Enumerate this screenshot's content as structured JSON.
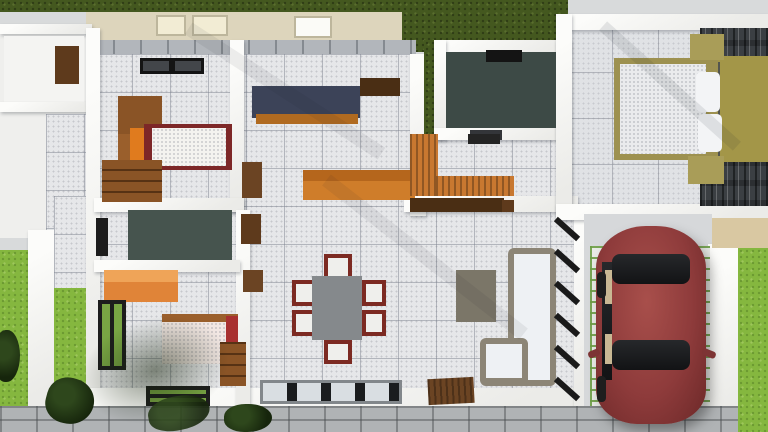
{
  "meta": {
    "canvas_width": 768,
    "canvas_height": 432,
    "content": "3d-house-floor-plan-top-view-render"
  },
  "palette": {
    "lawn_dark": "#44581f",
    "lawn_bright": "#85b73f",
    "wall_white": "#f5f5f2",
    "tile_floor": "#e6e7e9",
    "bath_floor_teal": "#3d4a46",
    "kitchen_counter_navy": "#3c4358",
    "wood_orange": "#cf7d2a",
    "wardrobe_orange": "#e08438",
    "wood_brown": "#8a5426",
    "bed_frame_red": "#7d2727",
    "blanket_red": "#a83030",
    "khaki_bed": "#a99d58",
    "stone_accent": "#3b3f43",
    "sofa_frame": "#8c8576",
    "cushion_white": "#eef1f4",
    "table_grey": "#85898c",
    "chair_red": "#7c2a22",
    "car_maroon": "#8e3b3b",
    "paver_joint_green": "#6d9e46",
    "concrete": "#d8dadb",
    "fence_grey": "#b0b3b5",
    "door_wood": "#6b4423",
    "ceiling_beige": "#ddd5bc"
  },
  "scene": {
    "items": [
      {
        "n": "ground-concrete",
        "x": 0,
        "y": 0,
        "w": 768,
        "h": 432,
        "bg": "#d8dadb"
      },
      {
        "n": "ceiling-band",
        "x": 86,
        "y": 10,
        "w": 326,
        "h": 32,
        "bg": "#ddd5bc"
      },
      {
        "n": "lawn-back",
        "x": 0,
        "y": 0,
        "w": 566,
        "h": 12,
        "cls": "grass-d"
      },
      {
        "n": "lawn-notch",
        "x": 402,
        "y": 0,
        "w": 166,
        "h": 52,
        "cls": "grass-d"
      },
      {
        "n": "skylight-panel-1",
        "x": 156,
        "y": 15,
        "w": 30,
        "h": 21,
        "bg": "#f2ecd4",
        "cls": "panel"
      },
      {
        "n": "skylight-panel-2",
        "x": 192,
        "y": 15,
        "w": 36,
        "h": 21,
        "bg": "#f2ecd4",
        "cls": "panel"
      },
      {
        "n": "ceiling-light-panel",
        "x": 294,
        "y": 16,
        "w": 38,
        "h": 22,
        "bg": "#fbfbf7",
        "cls": "panel"
      },
      {
        "n": "back-wall-tiles",
        "x": 86,
        "y": 40,
        "w": 330,
        "h": 18,
        "cls": "tileband"
      },
      {
        "n": "utility-block",
        "x": 0,
        "y": 24,
        "w": 92,
        "h": 214,
        "bg": "#efefed"
      },
      {
        "n": "utility-wall-top",
        "x": 0,
        "y": 24,
        "w": 92,
        "h": 10,
        "cls": "wall"
      },
      {
        "n": "utility-room-floor",
        "x": 4,
        "y": 36,
        "w": 80,
        "h": 66,
        "bg": "#f4f4f2"
      },
      {
        "n": "utility-wall-mid",
        "x": 0,
        "y": 102,
        "w": 92,
        "h": 10,
        "cls": "wall"
      },
      {
        "n": "utility-room2-tiles",
        "x": 46,
        "y": 114,
        "w": 40,
        "h": 120,
        "cls": "tiles"
      },
      {
        "n": "utility-wood-cabinet",
        "x": 55,
        "y": 46,
        "w": 24,
        "h": 38,
        "bg": "#5e3a1c"
      },
      {
        "n": "lawn-left-outer",
        "x": 0,
        "y": 250,
        "w": 30,
        "h": 162,
        "cls": "grass-b"
      },
      {
        "n": "boundary-wall-left",
        "x": 28,
        "y": 230,
        "w": 28,
        "h": 182,
        "cls": "wall"
      },
      {
        "n": "patio-tiles-left",
        "x": 54,
        "y": 196,
        "w": 40,
        "h": 92,
        "cls": "tiles"
      },
      {
        "n": "lawn-left-inner",
        "x": 54,
        "y": 288,
        "w": 40,
        "h": 122,
        "cls": "grass-b"
      },
      {
        "n": "main-floor",
        "x": 94,
        "y": 54,
        "w": 492,
        "h": 348,
        "cls": "tiles"
      },
      {
        "n": "master-floor",
        "x": 566,
        "y": 26,
        "w": 202,
        "h": 190,
        "cls": "tiles-big"
      },
      {
        "n": "wall-main-left",
        "x": 86,
        "y": 28,
        "w": 14,
        "h": 382,
        "cls": "wall"
      },
      {
        "n": "wall-main-bottom",
        "x": 86,
        "y": 388,
        "w": 504,
        "h": 22,
        "cls": "wall"
      },
      {
        "n": "wall-living-right",
        "x": 574,
        "y": 210,
        "w": 18,
        "h": 200,
        "cls": "wall"
      },
      {
        "n": "wall-bed2-right",
        "x": 230,
        "y": 40,
        "w": 14,
        "h": 172,
        "cls": "wall"
      },
      {
        "n": "wall-bed2-bottom",
        "x": 94,
        "y": 198,
        "w": 150,
        "h": 14,
        "cls": "wall"
      },
      {
        "n": "wall-leftrooms-right",
        "x": 236,
        "y": 210,
        "w": 14,
        "h": 200,
        "cls": "wall"
      },
      {
        "n": "wall-bath2-bottom",
        "x": 94,
        "y": 260,
        "w": 146,
        "h": 12,
        "cls": "wall"
      },
      {
        "n": "wall-kitchen-right",
        "x": 410,
        "y": 54,
        "w": 16,
        "h": 162,
        "cls": "wall"
      },
      {
        "n": "lawn-bath1-left",
        "x": 424,
        "y": 40,
        "w": 14,
        "h": 94,
        "cls": "grass-d"
      },
      {
        "n": "wall-utility2-bottom",
        "x": 404,
        "y": 196,
        "w": 174,
        "h": 16,
        "cls": "wall"
      },
      {
        "n": "wall-bath1-top",
        "x": 434,
        "y": 40,
        "w": 136,
        "h": 12,
        "cls": "wall"
      },
      {
        "n": "wall-bath1-left",
        "x": 434,
        "y": 40,
        "w": 12,
        "h": 100,
        "cls": "wall"
      },
      {
        "n": "wall-bath1-bottom",
        "x": 434,
        "y": 128,
        "w": 136,
        "h": 12,
        "cls": "wall"
      },
      {
        "n": "wall-bath1-right",
        "x": 556,
        "y": 40,
        "w": 14,
        "h": 176,
        "cls": "wall"
      },
      {
        "n": "wall-master-top",
        "x": 556,
        "y": 14,
        "w": 212,
        "h": 16,
        "cls": "wall"
      },
      {
        "n": "wall-master-left",
        "x": 556,
        "y": 14,
        "w": 16,
        "h": 204,
        "cls": "wall"
      },
      {
        "n": "wall-master-bottom",
        "x": 556,
        "y": 204,
        "w": 212,
        "h": 16,
        "cls": "wall"
      },
      {
        "n": "master-stone-accent-wall",
        "x": 700,
        "y": 28,
        "w": 68,
        "h": 178,
        "cls": "stone"
      },
      {
        "n": "master-headboard-rug",
        "x": 712,
        "y": 56,
        "w": 56,
        "h": 106,
        "bg": "#a39648"
      },
      {
        "n": "master-headboard",
        "x": 708,
        "y": 62,
        "w": 12,
        "h": 96,
        "bg": "#53554f"
      },
      {
        "n": "master-bed-frame",
        "x": 614,
        "y": 58,
        "w": 104,
        "h": 102,
        "bg": "#9d9150"
      },
      {
        "n": "master-mattress",
        "x": 620,
        "y": 64,
        "w": 86,
        "h": 90,
        "bg": "#eaebed",
        "cls": "speck"
      },
      {
        "n": "master-pillow-1",
        "x": 696,
        "y": 72,
        "w": 24,
        "h": 40,
        "bg": "#f3f4f6",
        "r": 5
      },
      {
        "n": "master-pillow-2",
        "x": 698,
        "y": 114,
        "w": 24,
        "h": 38,
        "bg": "#f3f4f6",
        "r": 5
      },
      {
        "n": "master-nightstand-top",
        "x": 690,
        "y": 34,
        "w": 34,
        "h": 26,
        "bg": "#a99d58"
      },
      {
        "n": "master-nightstand-bottom",
        "x": 688,
        "y": 156,
        "w": 36,
        "h": 28,
        "bg": "#a99d58"
      },
      {
        "n": "master-floor-shadow",
        "x": 580,
        "y": 80,
        "w": 180,
        "h": 12,
        "rot": 42,
        "op": 0.1,
        "cls": "shadowstreak"
      },
      {
        "n": "bed2-ceiling-light",
        "x": 140,
        "y": 58,
        "w": 64,
        "h": 16,
        "cls": "skylight"
      },
      {
        "n": "bed2-wardrobe-upper",
        "x": 118,
        "y": 96,
        "w": 44,
        "h": 42,
        "bg": "#8a5426"
      },
      {
        "n": "bed2-wardrobe-lower",
        "x": 118,
        "y": 134,
        "w": 40,
        "h": 40,
        "bg": "#9a5f2c"
      },
      {
        "n": "bed2-wardrobe-door-orange",
        "x": 130,
        "y": 128,
        "w": 22,
        "h": 36,
        "bg": "#e07b1e"
      },
      {
        "n": "bed2-bed-frame",
        "x": 144,
        "y": 124,
        "w": 88,
        "h": 46,
        "bg": "#7d2727"
      },
      {
        "n": "bed2-mattress",
        "x": 152,
        "y": 128,
        "w": 74,
        "h": 38,
        "bg": "#f4f3ef",
        "cls": "speck"
      },
      {
        "n": "bed2-dresser",
        "x": 102,
        "y": 160,
        "w": 60,
        "h": 42,
        "bg": "#8a5426",
        "cls": "drawers"
      },
      {
        "n": "bath2-floor",
        "x": 128,
        "y": 210,
        "w": 104,
        "h": 50,
        "bg": "#46544e"
      },
      {
        "n": "bath2-window",
        "x": 96,
        "y": 218,
        "w": 12,
        "h": 38,
        "bg": "#1c1c1c"
      },
      {
        "n": "bed3-wardrobe",
        "x": 104,
        "y": 270,
        "w": 74,
        "h": 32,
        "bg": "#e08438"
      },
      {
        "n": "bed3-wardrobe-top",
        "x": 104,
        "y": 270,
        "w": 74,
        "h": 12,
        "bg": "#efa458"
      },
      {
        "n": "bed3-bed-headrail",
        "x": 162,
        "y": 314,
        "w": 76,
        "h": 10,
        "bg": "#9a5f2c"
      },
      {
        "n": "bed3-mattress",
        "x": 162,
        "y": 322,
        "w": 70,
        "h": 42,
        "bg": "#f2e7e3",
        "cls": "speck"
      },
      {
        "n": "bed3-blanket-red",
        "x": 226,
        "y": 316,
        "w": 12,
        "h": 48,
        "bg": "#a83030"
      },
      {
        "n": "bed3-nightstand",
        "x": 220,
        "y": 342,
        "w": 26,
        "h": 44,
        "bg": "#8a5426",
        "cls": "drawers"
      },
      {
        "n": "bed3-window-left",
        "x": 98,
        "y": 300,
        "w": 28,
        "h": 70,
        "cls": "window-green"
      },
      {
        "n": "bed3-window-bottom",
        "x": 146,
        "y": 386,
        "w": 64,
        "h": 20,
        "cls": "window-green-h"
      },
      {
        "n": "wall-niche-1",
        "x": 242,
        "y": 162,
        "w": 20,
        "h": 36,
        "bg": "#6b4423"
      },
      {
        "n": "wall-niche-2",
        "x": 241,
        "y": 214,
        "w": 20,
        "h": 30,
        "bg": "#5e3a1c"
      },
      {
        "n": "wall-niche-3",
        "x": 243,
        "y": 270,
        "w": 20,
        "h": 22,
        "bg": "#6b4423"
      },
      {
        "n": "dining-chair-top",
        "x": 324,
        "y": 254,
        "w": 28,
        "h": 26,
        "cls": "chair"
      },
      {
        "n": "dining-chair-bottom",
        "x": 324,
        "y": 340,
        "w": 28,
        "h": 24,
        "cls": "chair"
      },
      {
        "n": "dining-chair-left-1",
        "x": 292,
        "y": 280,
        "w": 24,
        "h": 26,
        "cls": "chair"
      },
      {
        "n": "dining-chair-left-2",
        "x": 292,
        "y": 310,
        "w": 24,
        "h": 26,
        "cls": "chair"
      },
      {
        "n": "dining-chair-right-1",
        "x": 362,
        "y": 280,
        "w": 24,
        "h": 26,
        "cls": "chair"
      },
      {
        "n": "dining-chair-right-2",
        "x": 362,
        "y": 310,
        "w": 24,
        "h": 26,
        "cls": "chair"
      },
      {
        "n": "dining-table",
        "x": 312,
        "y": 276,
        "w": 50,
        "h": 64,
        "bg": "#85898c"
      },
      {
        "n": "dining-window",
        "x": 260,
        "y": 380,
        "w": 142,
        "h": 24,
        "cls": "window-big"
      },
      {
        "n": "kitchen-counter-top",
        "x": 252,
        "y": 86,
        "w": 108,
        "h": 32,
        "bg": "#3c4358"
      },
      {
        "n": "kitchen-counter-face",
        "x": 256,
        "y": 114,
        "w": 102,
        "h": 10,
        "bg": "#b06a20"
      },
      {
        "n": "kitchen-wall-cabinet",
        "x": 360,
        "y": 78,
        "w": 40,
        "h": 18,
        "bg": "#4a2e14"
      },
      {
        "n": "kitchen-island",
        "x": 303,
        "y": 170,
        "w": 112,
        "h": 30,
        "bg": "#cf7d2a"
      },
      {
        "n": "kitchen-island-top",
        "x": 303,
        "y": 170,
        "w": 112,
        "h": 11,
        "bg": "#b5661c"
      },
      {
        "n": "bath1-floor",
        "x": 446,
        "y": 52,
        "w": 110,
        "h": 76,
        "bg": "#3d4a46"
      },
      {
        "n": "bath1-skylight",
        "x": 486,
        "y": 50,
        "w": 36,
        "h": 12,
        "bg": "#141414"
      },
      {
        "n": "bath1-door",
        "x": 470,
        "y": 130,
        "w": 32,
        "h": 10,
        "bg": "#333539"
      },
      {
        "n": "utility2-counter-left",
        "x": 410,
        "y": 134,
        "w": 28,
        "h": 62,
        "bg": "#c87830",
        "cls": "woodgrain"
      },
      {
        "n": "utility2-counter-bottom",
        "x": 436,
        "y": 176,
        "w": 78,
        "h": 20,
        "bg": "#c87830",
        "cls": "woodgrain"
      },
      {
        "n": "utility2-shelf",
        "x": 468,
        "y": 134,
        "w": 32,
        "h": 10,
        "bg": "#242424"
      },
      {
        "n": "tv-console",
        "x": 410,
        "y": 198,
        "w": 94,
        "h": 14,
        "bg": "#4a2e14"
      },
      {
        "n": "tv-console-step",
        "x": 502,
        "y": 200,
        "w": 12,
        "h": 12,
        "bg": "#5e3a1c"
      },
      {
        "n": "coffee-table",
        "x": 456,
        "y": 270,
        "w": 40,
        "h": 52,
        "bg": "#7b7668"
      },
      {
        "n": "sofa-frame-long",
        "x": 508,
        "y": 248,
        "w": 48,
        "h": 138,
        "bg": "#8c8576",
        "r": 6
      },
      {
        "n": "sofa-cushions-long",
        "x": 514,
        "y": 254,
        "w": 36,
        "h": 126,
        "bg": "#eef1f4"
      },
      {
        "n": "sofa-frame-short",
        "x": 480,
        "y": 338,
        "w": 48,
        "h": 48,
        "bg": "#8c8576",
        "r": 6
      },
      {
        "n": "sofa-cushions-short",
        "x": 486,
        "y": 344,
        "w": 36,
        "h": 34,
        "bg": "#eef1f4"
      },
      {
        "n": "window-louver-1",
        "x": 552,
        "y": 226,
        "w": 30,
        "h": 6,
        "rot": 42,
        "bg": "#1a1a1a"
      },
      {
        "n": "window-louver-2",
        "x": 552,
        "y": 258,
        "w": 30,
        "h": 6,
        "rot": 42,
        "bg": "#1a1a1a"
      },
      {
        "n": "window-louver-3",
        "x": 552,
        "y": 290,
        "w": 30,
        "h": 6,
        "rot": 42,
        "bg": "#1a1a1a"
      },
      {
        "n": "window-louver-4",
        "x": 552,
        "y": 322,
        "w": 30,
        "h": 6,
        "rot": 42,
        "bg": "#1a1a1a"
      },
      {
        "n": "window-louver-5",
        "x": 552,
        "y": 354,
        "w": 30,
        "h": 6,
        "rot": 42,
        "bg": "#1a1a1a"
      },
      {
        "n": "window-louver-6",
        "x": 552,
        "y": 386,
        "w": 30,
        "h": 6,
        "rot": 42,
        "bg": "#1a1a1a"
      },
      {
        "n": "entry-door-mat",
        "x": 428,
        "y": 378,
        "w": 46,
        "h": 26,
        "bg": "#6b4423",
        "cls": "woodgrain",
        "rot": -3
      },
      {
        "n": "garage-slab",
        "x": 584,
        "y": 214,
        "w": 128,
        "h": 218,
        "bg": "#d6d8da"
      },
      {
        "n": "garage-wall-right",
        "x": 708,
        "y": 244,
        "w": 34,
        "h": 188,
        "cls": "wall"
      },
      {
        "n": "garage-wall-top-beige",
        "x": 712,
        "y": 218,
        "w": 56,
        "h": 30,
        "bg": "#d9c8a2"
      },
      {
        "n": "driveway-pavers-left",
        "x": 590,
        "y": 246,
        "w": 32,
        "h": 164,
        "cls": "pavers"
      },
      {
        "n": "driveway-pavers-right",
        "x": 680,
        "y": 246,
        "w": 30,
        "h": 164,
        "cls": "pavers"
      },
      {
        "n": "fence-front",
        "x": 0,
        "y": 406,
        "w": 768,
        "h": 26,
        "cls": "fence"
      },
      {
        "n": "lawn-right",
        "x": 738,
        "y": 248,
        "w": 30,
        "h": 184,
        "cls": "grass-b"
      },
      {
        "n": "car-body",
        "x": 596,
        "y": 226,
        "w": 110,
        "h": 198,
        "cls": "car"
      },
      {
        "n": "car-rear-glass",
        "x": 612,
        "y": 254,
        "w": 78,
        "h": 30,
        "cls": "glass",
        "r": 8
      },
      {
        "n": "car-side-windows",
        "x": 602,
        "y": 262,
        "w": 10,
        "h": 118,
        "cls": "glass"
      },
      {
        "n": "car-seat-1",
        "x": 605,
        "y": 270,
        "w": 7,
        "h": 34,
        "bg": "#c9b894"
      },
      {
        "n": "car-seat-2",
        "x": 605,
        "y": 334,
        "w": 7,
        "h": 30,
        "bg": "#c9b894"
      },
      {
        "n": "car-front-glass",
        "x": 612,
        "y": 340,
        "w": 78,
        "h": 30,
        "cls": "glass",
        "r": 8
      },
      {
        "n": "car-mirror-right",
        "x": 702,
        "y": 350,
        "w": 14,
        "h": 7,
        "bg": "#7d3434",
        "rot": 22,
        "r": 3
      },
      {
        "n": "car-mirror-left",
        "x": 588,
        "y": 350,
        "w": 12,
        "h": 7,
        "bg": "#7d3434",
        "rot": -22,
        "r": 3
      },
      {
        "n": "car-wheel-rear",
        "x": 597,
        "y": 272,
        "w": 9,
        "h": 26,
        "bg": "#1e1e1e",
        "r": 4
      },
      {
        "n": "car-wheel-front",
        "x": 597,
        "y": 376,
        "w": 9,
        "h": 26,
        "bg": "#1e1e1e",
        "r": 4
      },
      {
        "n": "tree-shadow",
        "x": 80,
        "y": 318,
        "w": 150,
        "h": 104,
        "cls": "blob",
        "rot": -15
      },
      {
        "n": "plant-left-edge",
        "x": -6,
        "y": 330,
        "w": 26,
        "h": 52,
        "cls": "plant"
      },
      {
        "n": "plant-left",
        "x": 46,
        "y": 378,
        "w": 48,
        "h": 46,
        "cls": "plant",
        "rot": 15
      },
      {
        "n": "plant-path",
        "x": 148,
        "y": 396,
        "w": 62,
        "h": 34,
        "cls": "plant",
        "rot": -10,
        "op": 0.9
      },
      {
        "n": "bush-front",
        "x": 224,
        "y": 404,
        "w": 48,
        "h": 28,
        "cls": "plant"
      },
      {
        "n": "floor-shadow-1",
        "x": 170,
        "y": 84,
        "w": 230,
        "h": 14,
        "rot": 33,
        "op": 0.07,
        "cls": "shadowstreak"
      },
      {
        "n": "floor-shadow-2",
        "x": 300,
        "y": 250,
        "w": 250,
        "h": 14,
        "rot": 38,
        "op": 0.07,
        "cls": "shadowstreak"
      }
    ]
  }
}
